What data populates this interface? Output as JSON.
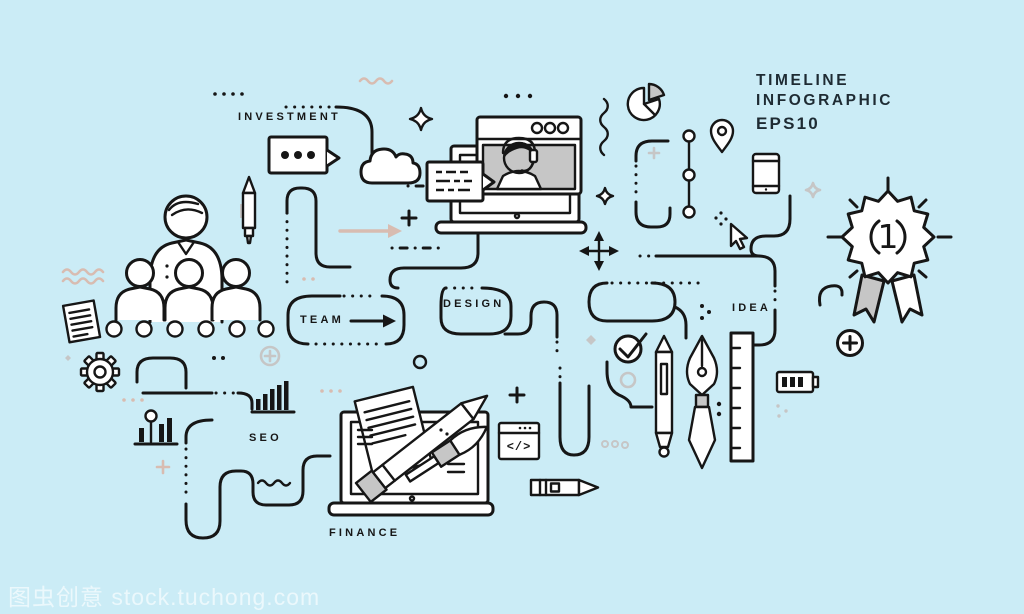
{
  "canvas": {
    "background": "#cbecf6"
  },
  "colors": {
    "line": "#161616",
    "gray": "#c6c6c6",
    "warm": "#d8bcb1",
    "panel": "#c6c6c6",
    "face": "#cdeef7",
    "title_text": "#1e2b33",
    "watermark_text": "rgba(255,255,255,0.62)"
  },
  "header": {
    "title_line1": "TIMELINE",
    "title_line2": "INFOGRAPHIC",
    "title_line3": "EPS10"
  },
  "stage_labels": {
    "investment": "INVESTMENT",
    "team": "TEAM",
    "design": "DESIGN",
    "idea": "IDEA",
    "seo": "SEO",
    "finance": "FINANCE"
  },
  "award_badge": {
    "rank": "1"
  },
  "code_window": {
    "glyph": "</>"
  },
  "watermark": {
    "text": "图虫创意 stock.tuchong.com"
  },
  "icons": [
    "team-group",
    "timeline-node-dots",
    "document",
    "gear",
    "pencil",
    "chat-bubble-dots",
    "cloud",
    "laptop-video-call",
    "support-agent",
    "message-bubble",
    "pie-chart",
    "zigzag-line",
    "location-pin",
    "milestone-line",
    "smartphone",
    "mouse-cursor",
    "move-arrows",
    "award-ribbon",
    "plus-circle",
    "battery",
    "checkmark-circle",
    "stylus-pen",
    "fountain-pen",
    "ruler",
    "pencil-horizontal",
    "code-window",
    "laptop-workspace",
    "paper-sheet",
    "paint-brush",
    "bar-chart-lollipop",
    "bar-chart",
    "winding-path"
  ]
}
